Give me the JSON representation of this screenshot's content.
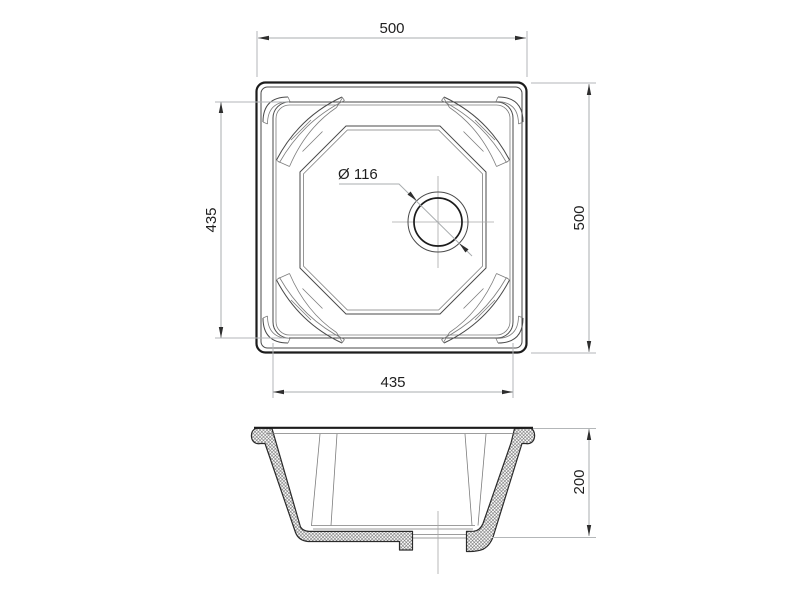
{
  "dimensions": {
    "top_width": "500",
    "left_inner_height": "435",
    "right_height": "500",
    "bottom_inner_width": "435",
    "drain_diameter": "Ø 116",
    "section_height": "200"
  },
  "colors": {
    "background": "#ffffff",
    "outline": "#1c1c1c",
    "detail_line": "#4a4a4a",
    "thin_line": "#7d7d7d",
    "extension_line": "#b3b6b8",
    "dimension_line": "#a9adaf",
    "center_line": "#a8a8a8",
    "text": "#1f1f1f",
    "arrow": "#2e2e2e"
  }
}
